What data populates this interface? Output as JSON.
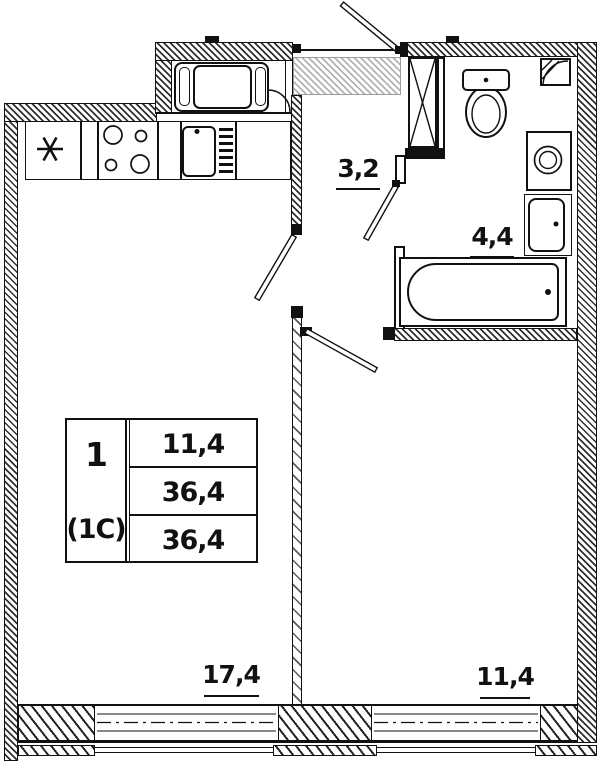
{
  "legend_table": {
    "flat_number": "1",
    "flat_type": "(1C)",
    "values": [
      "11,4",
      "36,4",
      "36,4"
    ]
  },
  "room_labels": {
    "hallway": "3,2",
    "bathroom": "4,4",
    "kitchen_living": "17,4",
    "room": "11,4"
  },
  "symbols": [
    "stove-4-burner",
    "kitchen-sink",
    "dish-rack",
    "asterisk-appliance-spot",
    "built-in-cabinet",
    "entrance-door",
    "interior-door-leaf",
    "toilet",
    "washing-machine",
    "wash-basin",
    "bathtub",
    "vent-corner",
    "window"
  ],
  "colors": {
    "line": "#111111",
    "grey_zone_hatch": "#b3b3b3",
    "background": "#ffffff"
  }
}
